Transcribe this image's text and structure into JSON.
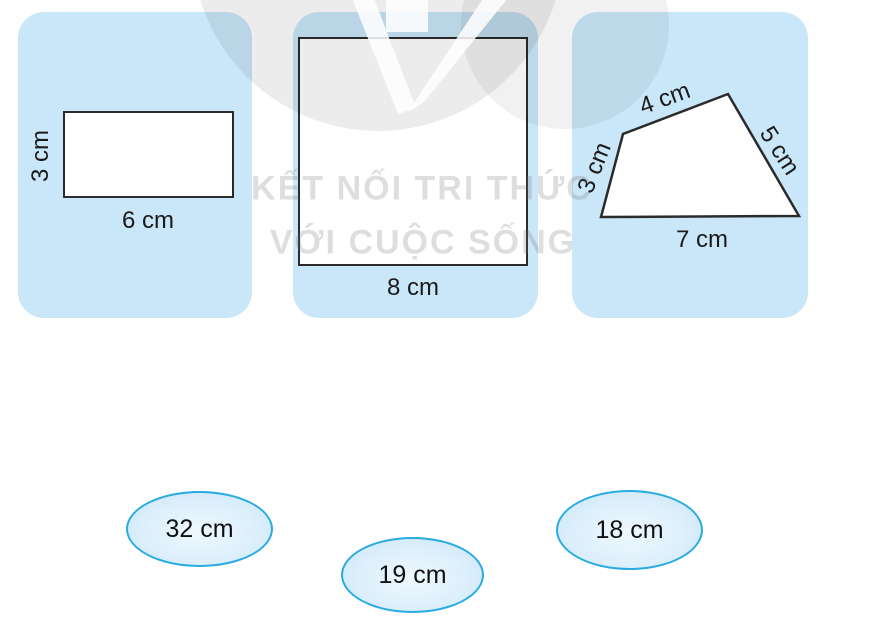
{
  "watermark": {
    "line1": "KẾT NỐI TRI THỨC",
    "line2": "VỚI CUỘC SỐNG"
  },
  "cards": [
    {
      "shape": "rectangle",
      "labels": {
        "height": "3 cm",
        "width": "6 cm"
      }
    },
    {
      "shape": "square",
      "labels": {
        "side": "8 cm"
      }
    },
    {
      "shape": "quadrilateral",
      "labels": {
        "left": "3 cm",
        "top": "4 cm",
        "right": "5 cm",
        "bottom": "7 cm"
      }
    }
  ],
  "answer_options": [
    {
      "value": "32 cm"
    },
    {
      "value": "19 cm"
    },
    {
      "value": "18 cm"
    }
  ],
  "colors": {
    "card_bg": "#c9e7f8",
    "shape_outline": "#2b2b2b",
    "option_border": "#29abe2",
    "label_color": "#1a1a1a"
  }
}
